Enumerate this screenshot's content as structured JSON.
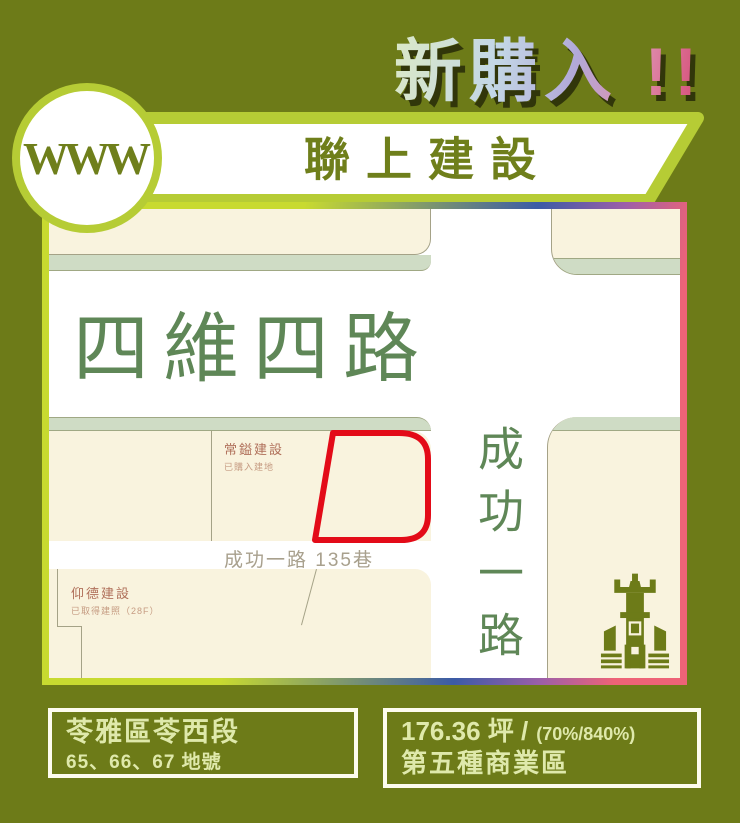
{
  "header": {
    "badge": "新購入 !!",
    "logo": "WWW",
    "company": "聯上建設"
  },
  "map": {
    "roads": {
      "horizontal": "四維四路",
      "vertical": "成功一路",
      "lane": "成功一路 135巷"
    },
    "neighbors": [
      {
        "name": "常鎰建設",
        "status": "已購入建地"
      },
      {
        "name": "仰德建設",
        "status": "已取得建照（28F）"
      }
    ],
    "highlight_parcel": "red-outline-parcel",
    "icon": "building-icon"
  },
  "footer": {
    "location": {
      "title": "苓雅區苓西段",
      "lots": "65、66、67 地號"
    },
    "details": {
      "area": "176.36 坪 /",
      "coverage": "(70%/840%)",
      "zoning": "第五種商業區"
    }
  },
  "colors": {
    "background_olive": "#6d7b18",
    "accent_green": "#b6cc35",
    "cream_block": "#f9f3de",
    "sage_strip": "#cfdcc5",
    "road_text_green": "#5f8757",
    "parcel_red": "#e30b18",
    "border_pink": "#ee6377",
    "border_blue": "#3b5ba6",
    "text_light_green": "#dfe9ab"
  }
}
